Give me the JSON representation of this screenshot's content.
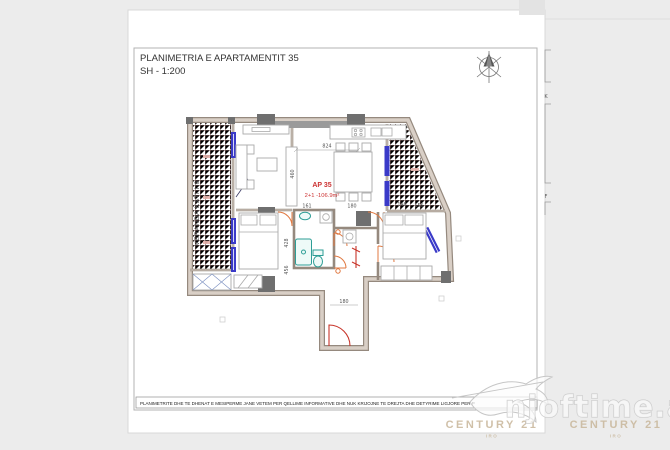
{
  "title_block": {
    "title": "PLANIMETRIA E APARTAMENTIT 35",
    "scale": "SH - 1:200"
  },
  "plan": {
    "apartment": {
      "code": "AP 35",
      "type_area": "2+1 -106.9m²"
    },
    "veranda_label": "VERANDA KATI I 6",
    "dimensions": {
      "kitchen_top": "824",
      "living_height": "460",
      "bath_width": "161",
      "hall_width": "180",
      "balcony_width_1": "146",
      "balcony_width_2": "155",
      "bed1_height": "428",
      "bed1_width": "456",
      "entry_width": "180"
    }
  },
  "footer": {
    "disclaimer": "PLANIMETRITE DHE TE DHENAT E MESIPERME JANE VETEM PER QELLIME INFORMATIVE DHE NUK KRIJOJNE TE DREJTA DHE DETYRIME LIGJORE PER P"
  },
  "margin_notes": {
    "note_k": "K",
    "note_f": "F"
  },
  "watermark": {
    "site": "njoftime.al",
    "brand_left": "CENTURY 21",
    "brand_left_sub": "IRO",
    "brand_right": "CENTURY 21",
    "brand_right_sub": "IRO"
  },
  "colors": {
    "page_bg": "#ececec",
    "sheet_bg": "#ffffff",
    "wall_edge": "#95897e",
    "wall_fill": "#d9cfc6",
    "window": "#3a3ac8",
    "door": "#e07840",
    "door_red": "#c8352a",
    "fixture": "#2e9e96",
    "furniture": "#aaaaaa",
    "column": "#6f6f6f",
    "label_red": "#cc3333",
    "tile": "#e8b2ac",
    "brand_gold": "#c8b69a",
    "watermark_gray": "#c6c6c6"
  }
}
